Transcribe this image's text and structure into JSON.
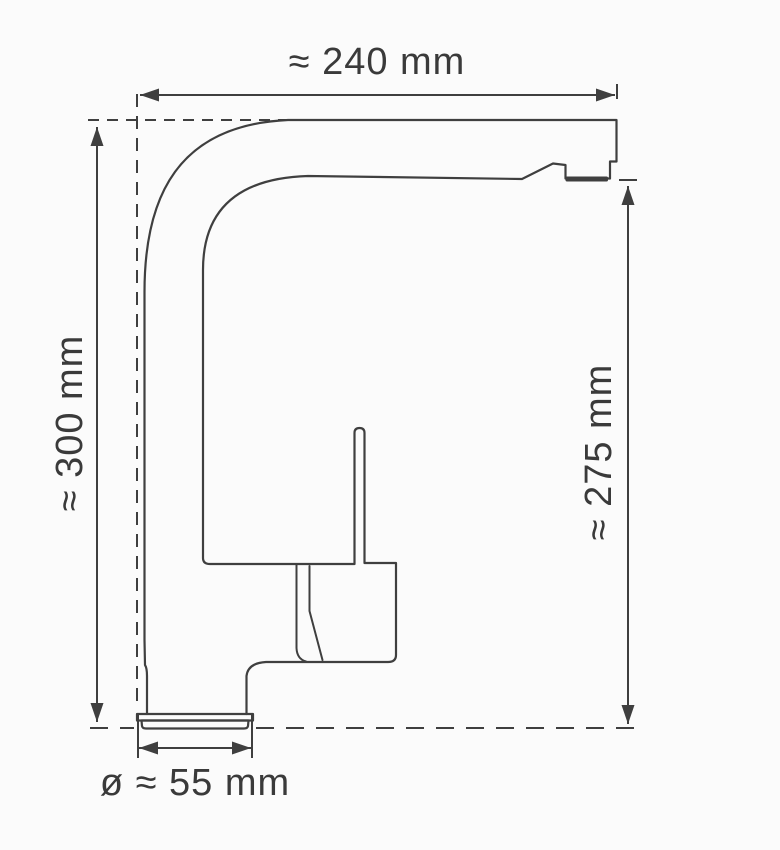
{
  "diagram": {
    "labels": {
      "top_width": "≈ 240 mm",
      "left_height": "≈ 300 mm",
      "right_height": "≈ 275 mm",
      "base_diameter": "ø ≈ 55 mm"
    },
    "values": {
      "top_width_mm": 240,
      "left_height_mm": 300,
      "right_height_mm": 275,
      "base_diameter_mm": 55
    },
    "colors": {
      "background": "#fbfbfb",
      "line": "#3f3f3f",
      "text": "#3a3a3a"
    }
  }
}
